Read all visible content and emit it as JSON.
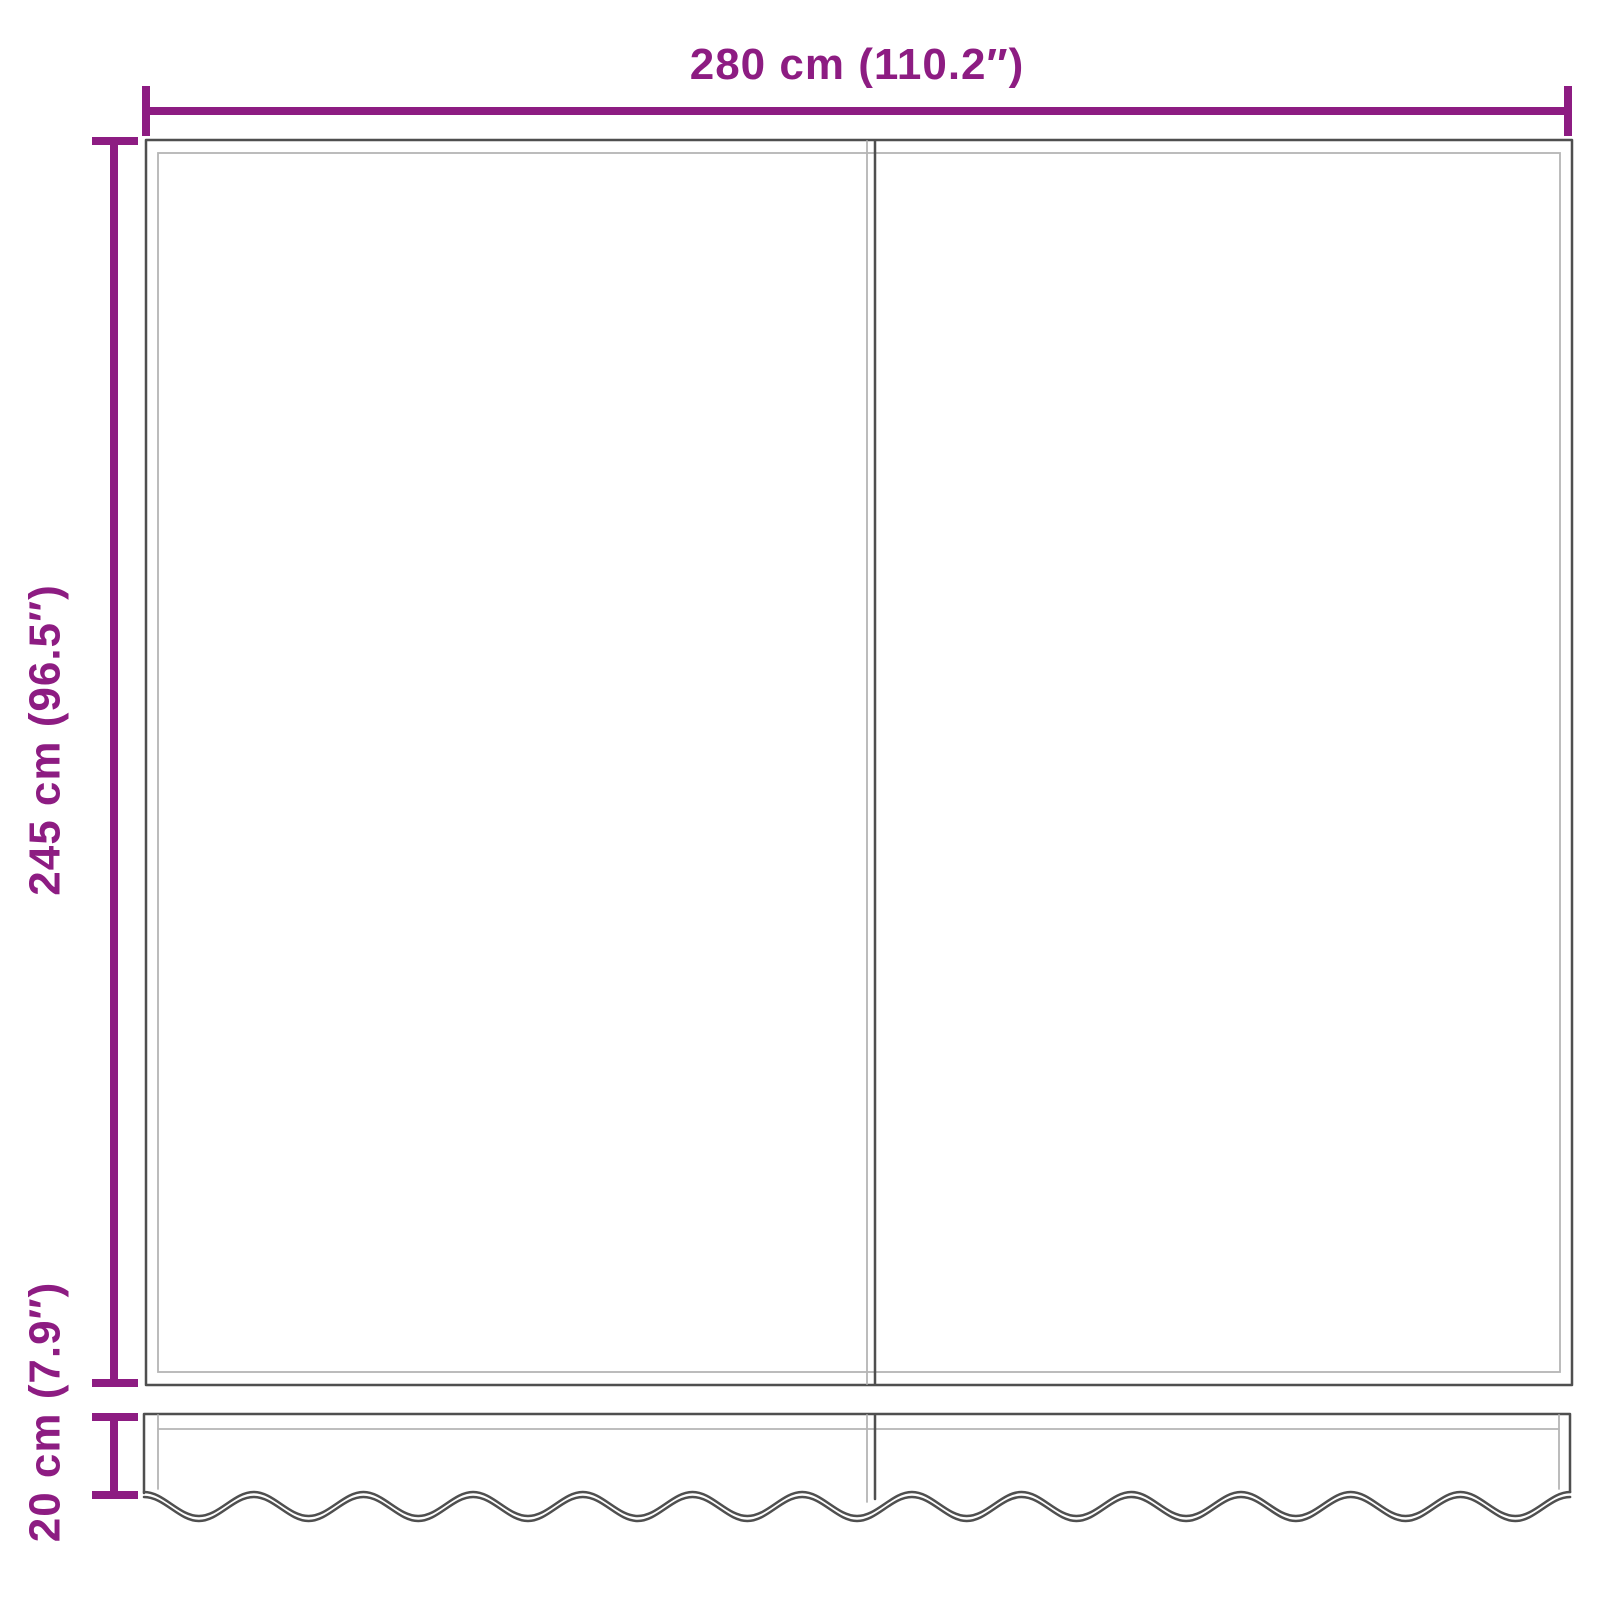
{
  "colors": {
    "accent": "#8d1c82",
    "line_dark": "#4f4f4f",
    "line_light": "#b5b5b5",
    "background": "#ffffff"
  },
  "diagram": {
    "type": "product-dimension-drawing",
    "subject": "awning replacement fabric with wavy valance",
    "dimensions": {
      "width_label": "280 cm (110.2″)",
      "height_label": "245 cm (96.5″)",
      "valance_height_label": "20 cm (7.9″)"
    }
  }
}
